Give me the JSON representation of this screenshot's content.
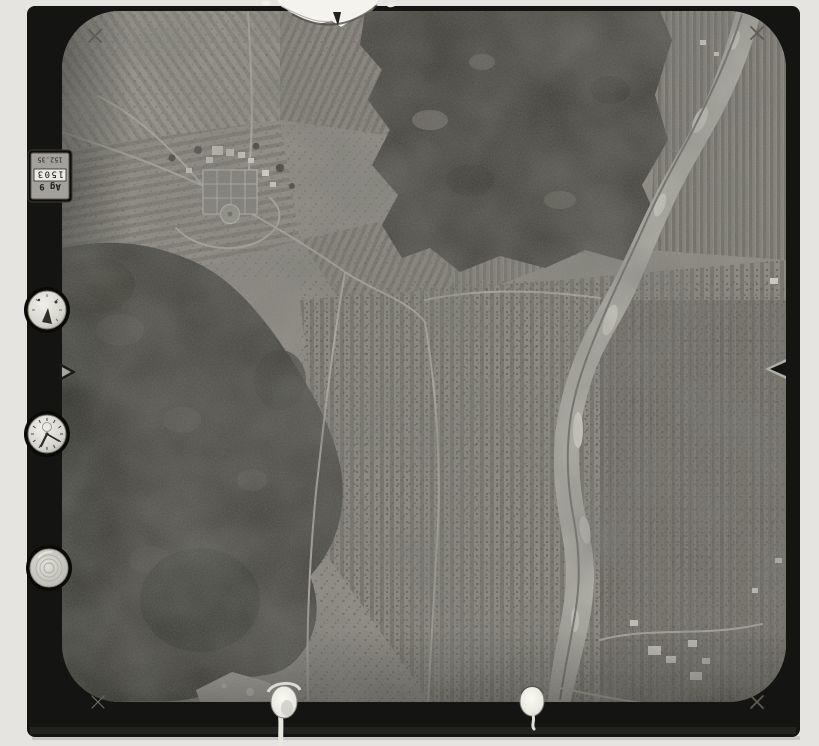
{
  "scan": {
    "background_color": "#e5e4e1",
    "film_frame_color": "#141412",
    "photo_base_color": "#8f8c84"
  },
  "data_plate": {
    "small_value": "152.35",
    "counter_value": "1503",
    "label": "Ag 9",
    "orientation": "rotated-180"
  },
  "instruments": [
    {
      "id": "altimeter-dial"
    },
    {
      "id": "clock-dial"
    },
    {
      "id": "level-dial"
    }
  ],
  "fiducials": {
    "corner_mark": "×",
    "corner_positions": [
      "top-left",
      "top-right",
      "bottom-left",
      "bottom-right"
    ],
    "edge_notches": [
      "left-edge",
      "right-edge"
    ]
  },
  "photo": {
    "description": "black-and-white vertical aerial survey photograph",
    "features": [
      "village with formal garden and white buildings",
      "strip fields and vineyard rows",
      "dark forested hill (west)",
      "dark forest mass (north)",
      "braided gravel river running north-south",
      "white farm buildings (south-east)",
      "torn emulsion at top edge",
      "chemical drip marks at bottom edge"
    ]
  }
}
